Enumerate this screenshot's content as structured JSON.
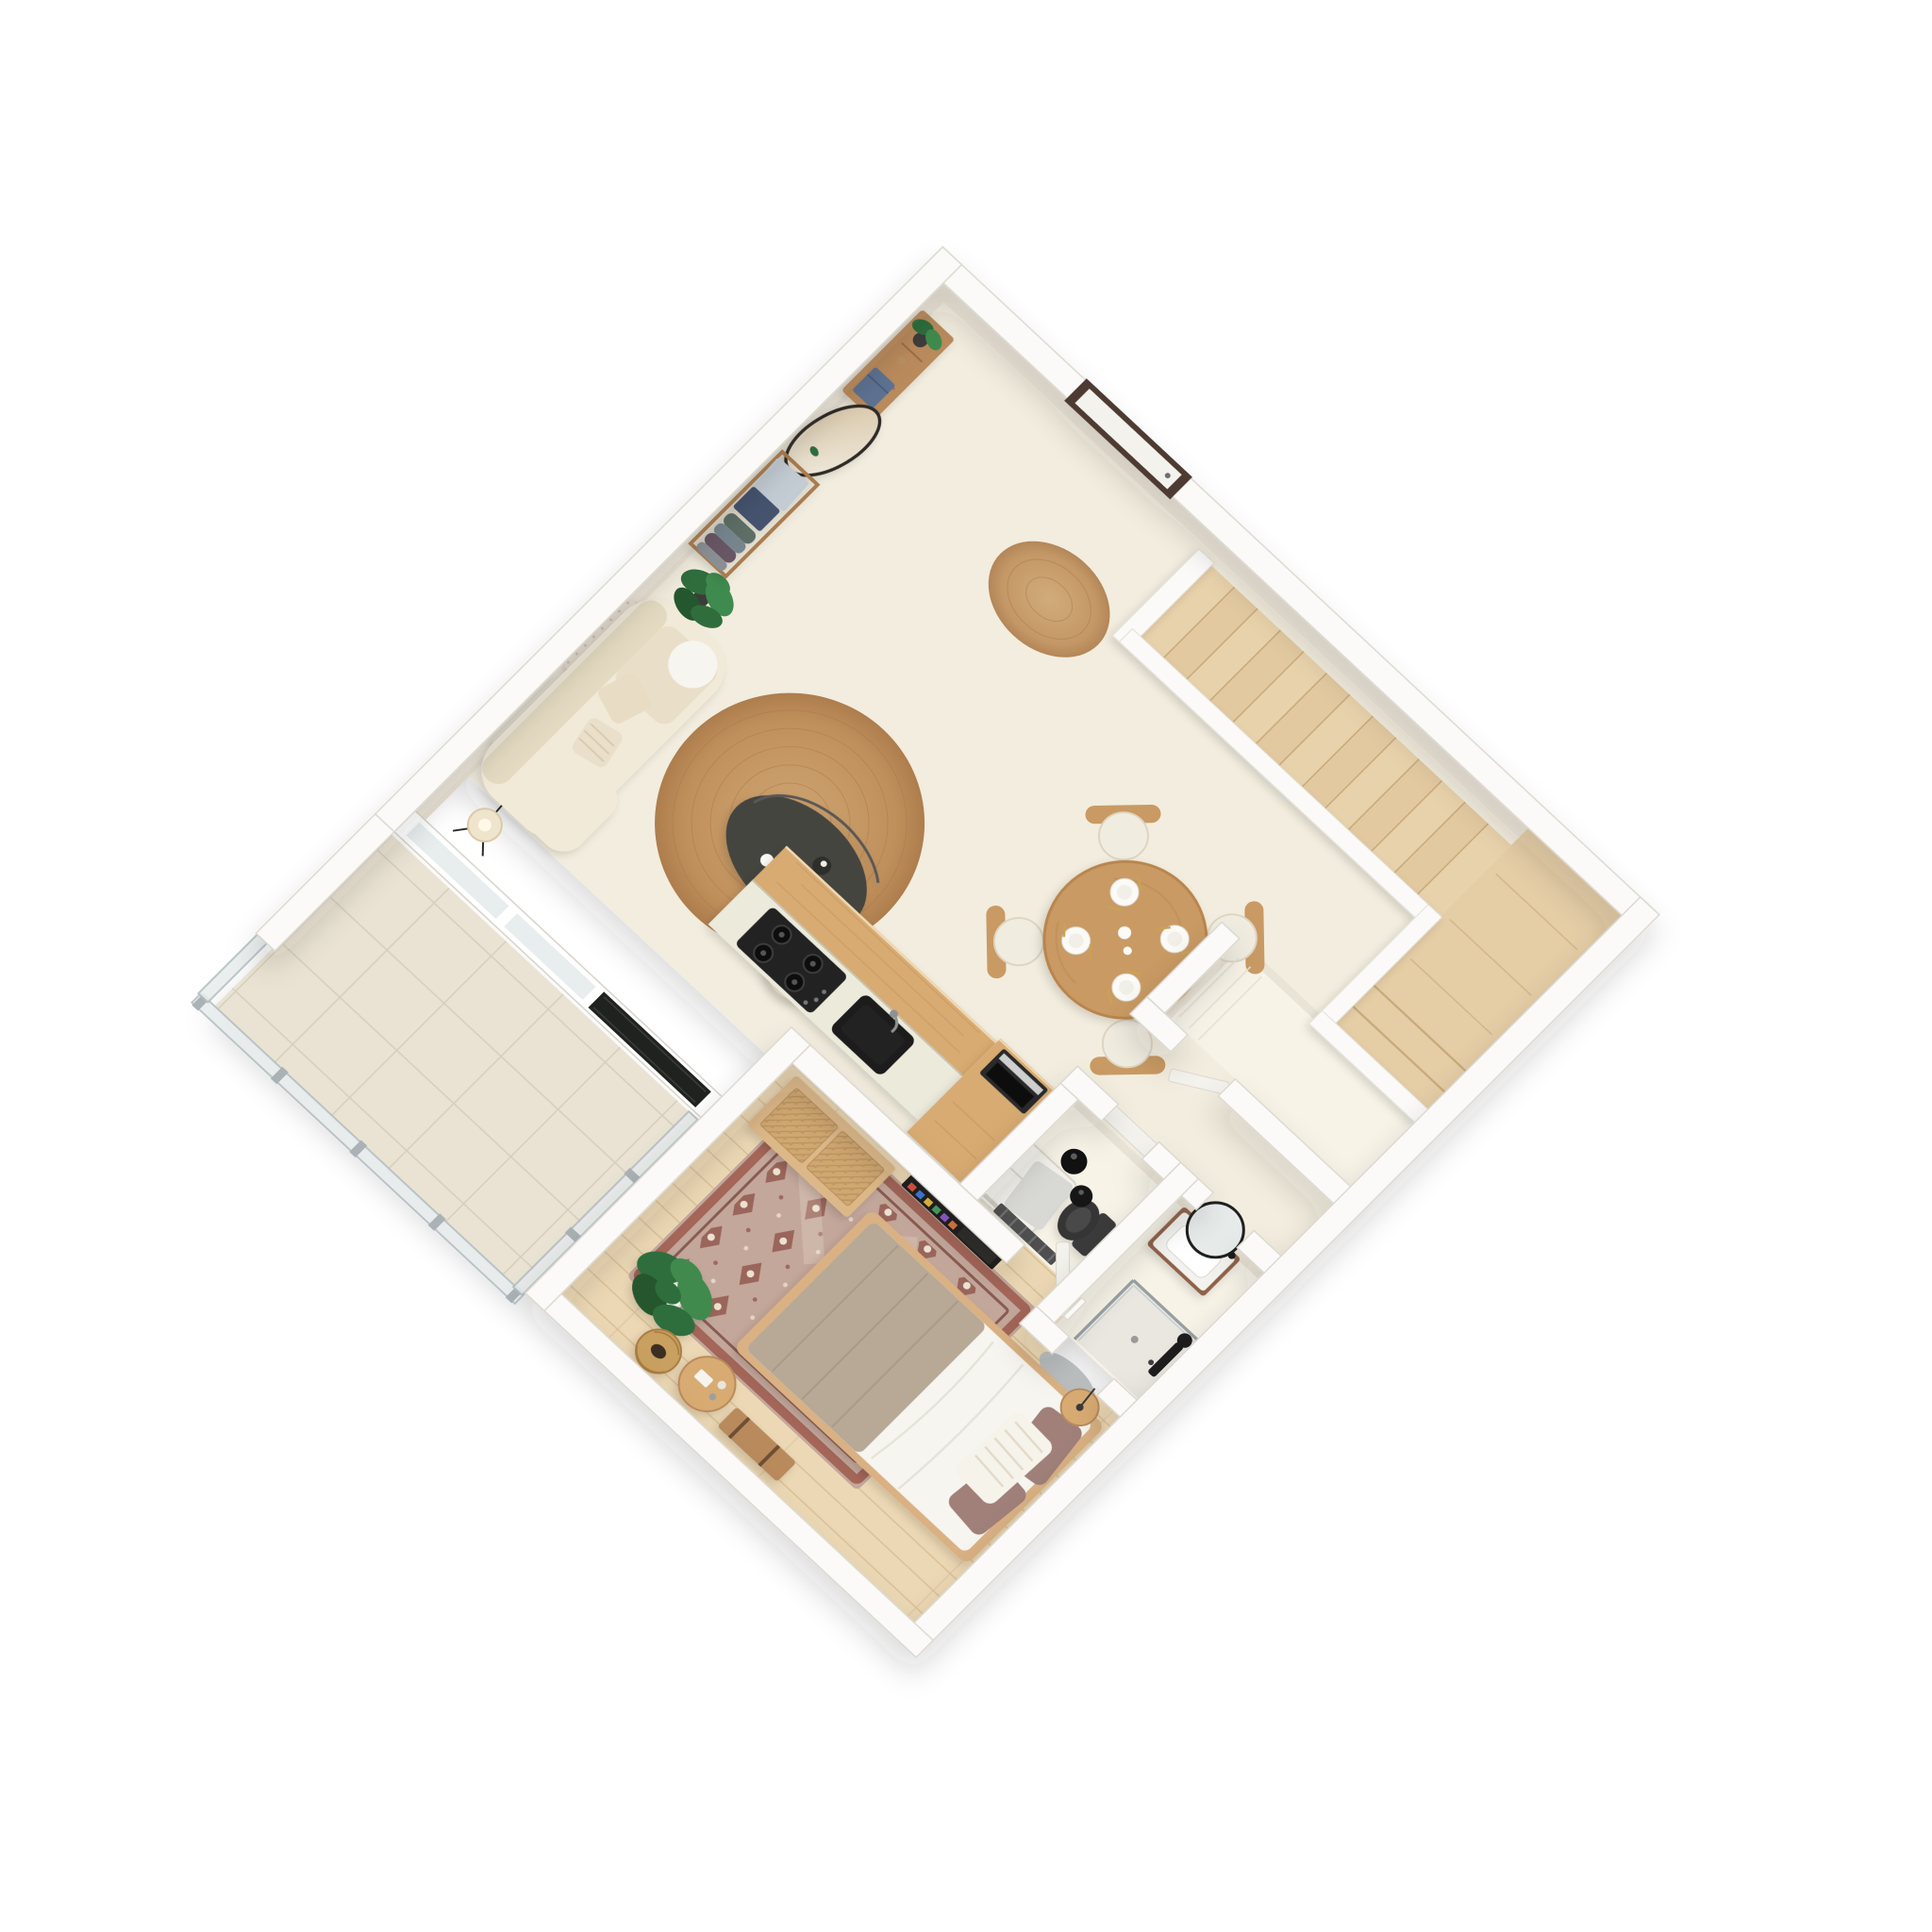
{
  "scene": {
    "type": "3d-isometric-floor-plan-render",
    "view": "top-down rotated 44 degrees",
    "background": "#ffffff",
    "no_visible_text": true
  },
  "palette": {
    "wall": "#fbfaf8",
    "wall_edge": "#d9d5cc",
    "wall_face": "#eae4d6",
    "floor_main": "#f2edde",
    "floor_light": "#f7f3e7",
    "floor_wood": "#ecd8b4",
    "plank_line": "#d9c096",
    "floor_tile": "#eae3d3",
    "tile_line": "#d7cfbd",
    "stair_wood": "#e8d2ab",
    "stair_wood_alt": "#e2c9a0",
    "stair_edge": "#c9ab7c",
    "landing_wood": "#e5cda6",
    "wood": "#d8ab72",
    "wood_dark": "#c99a63",
    "wood_deep": "#b98a5c",
    "walnut": "#8f6248",
    "counter": "#eceadb",
    "black": "#1d1d1d",
    "charcoal": "#454441",
    "sofa": "#f1ead9",
    "sofa_shade": "#e4dac2",
    "cream_pillow": "#e9dfc8",
    "taupe": "#b8a896",
    "duvet": "#f7f5f0",
    "mauve": "#a08079",
    "rug_field": "#c4a79b",
    "rug_accent": "#8c4f44",
    "rug_border": "#9e5a4c",
    "rug_light": "#ece2d2",
    "plant_green": "#2f6e3c",
    "plant_green_light": "#3f8a4e",
    "plant_green_deep": "#25572e",
    "glass": "#e8edee",
    "glass_edge": "#b4bec1",
    "metal": "#aab2b5",
    "gray_mat": "#b9bdbd",
    "wc_mat": "#d8d8d4",
    "navy_box": "#45536e",
    "steel_box": "#c3cbd3",
    "denim_box": "#5d7291",
    "door_frame": "#4e3b33",
    "door_leaf": "#f4f2ed",
    "gold": "#c9a254",
    "tv_screen": "#1b1b1b",
    "oven": "#2a2a2a",
    "white_appliance": "#f2f0ea",
    "plate": "#fbfaf7",
    "jute_inner": "#cfa672",
    "jute_outer": "#ae7d4d",
    "mirror_a": "#d8c6a6",
    "mirror_b": "#f0ebdf",
    "dark_glazing": "#20221f"
  },
  "rooms": [
    {
      "id": "entry",
      "name": "entry-hall",
      "furniture": [
        "front-door",
        "round-jute-doormat",
        "leaning-oval-mirror",
        "open-clothes-rack-with-boxes",
        "wood-sideboard",
        "blue-storage-box",
        "potted-plant"
      ]
    },
    {
      "id": "living",
      "name": "living-room",
      "furniture": [
        "textured-wall-art",
        "cream-curved-sofa",
        "throw-pillows",
        "monstera-plant",
        "tripod-floor-lamp",
        "round-jute-rug",
        "charcoal-oval-coffee-table",
        "vase",
        "cream-side-table"
      ]
    },
    {
      "id": "dining",
      "name": "dining-area",
      "furniture": [
        "round-wood-dining-table",
        "four-wood-chairs",
        "four-place-settings",
        "gold-cutlery"
      ]
    },
    {
      "id": "kitchen",
      "name": "kitchen",
      "furniture": [
        "island-with-raised-bar",
        "gas-cooktop",
        "black-sink",
        "tall-oven-cabinet",
        "built-in-oven",
        "white-fridge",
        "dark-glazed-window-to-balcony"
      ]
    },
    {
      "id": "stairs",
      "name": "staircase",
      "furniture": [
        "wood-flight-13-treads",
        "white-balustrade",
        "upper-landing",
        "landing-steps"
      ]
    },
    {
      "id": "storage",
      "name": "storage-room",
      "furniture": [
        "white-paneled-walls",
        "door-ajar"
      ]
    },
    {
      "id": "wc",
      "name": "wc",
      "furniture": [
        "two-black-pendant-lamps",
        "dark-toilet",
        "gray-mat",
        "towel-ladder-radiator",
        "door"
      ]
    },
    {
      "id": "bathroom",
      "name": "bathroom",
      "furniture": [
        "walnut-vanity",
        "white-sink",
        "round-black-rim-mirror",
        "walk-in-shower-glass",
        "black-shower-column",
        "half-round-gray-mat"
      ]
    },
    {
      "id": "bedroom",
      "name": "bedroom",
      "furniture": [
        "oak-plank-floor",
        "double-bed",
        "taupe-blanket",
        "white-duvet",
        "mauve-pillows",
        "striped-white-pillow",
        "persian-style-rug",
        "cane-door-dresser",
        "wall-mounted-tv",
        "fiddle-leaf-fig-plant",
        "round-side-table-with-bottles",
        "woven-basket",
        "wood-valet-bench",
        "nightstand-with-slim-lamp",
        "open-white-door"
      ]
    },
    {
      "id": "balcony",
      "name": "balcony",
      "furniture": [
        "beige-tile-floor",
        "glass-railing-with-metal-posts",
        "white-parapet-wall"
      ]
    }
  ]
}
